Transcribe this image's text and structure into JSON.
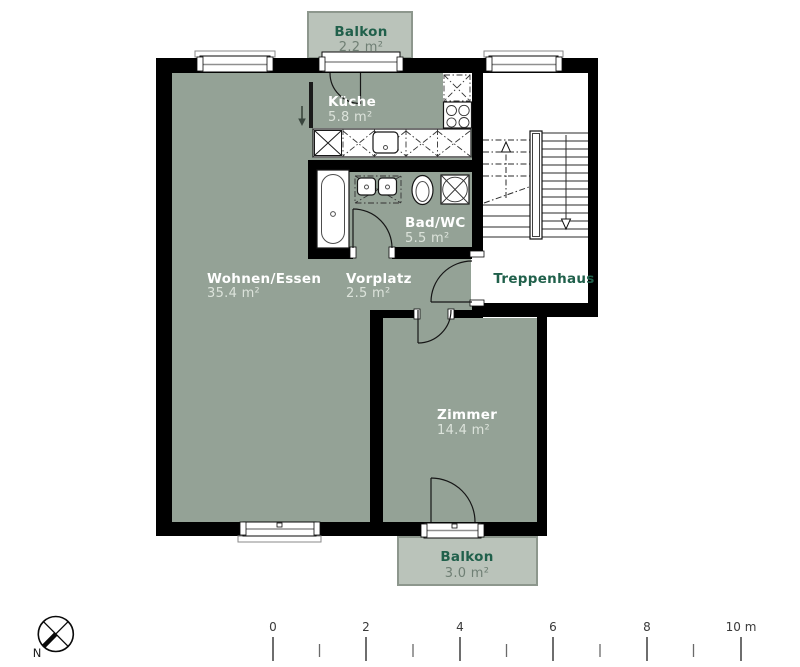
{
  "plan": {
    "rooms": [
      {
        "id": "balkon-top",
        "name": "Balkon",
        "area": "2.2 m²"
      },
      {
        "id": "kueche",
        "name": "Küche",
        "area": "5.8 m²"
      },
      {
        "id": "bad-wc",
        "name": "Bad/WC",
        "area": "5.5 m²"
      },
      {
        "id": "wohnen-essen",
        "name": "Wohnen/Essen",
        "area": "35.4 m²"
      },
      {
        "id": "vorplatz",
        "name": "Vorplatz",
        "area": "2.5 m²"
      },
      {
        "id": "treppenhaus",
        "name": "Treppenhaus",
        "area": ""
      },
      {
        "id": "zimmer",
        "name": "Zimmer",
        "area": "14.4 m²"
      },
      {
        "id": "balkon-bottom",
        "name": "Balkon",
        "area": "3.0 m²"
      }
    ],
    "fixtures": [
      "bathtub",
      "double-washbasin",
      "toilet",
      "washing-machine",
      "stove",
      "kitchen-sink",
      "refrigerator",
      "staircase"
    ],
    "compass": {
      "label": "N"
    },
    "scale_bar": {
      "unit": "m",
      "tick_labels": [
        "0",
        "2",
        "4",
        "6",
        "8",
        "10 m"
      ]
    },
    "colors": {
      "wall": "#000000",
      "room_fill": "#94A296",
      "balcony_fill": "#BAC3BA",
      "balcony_stroke": "#8D978D",
      "label_green": "#20604B",
      "room_name": "#FFFFFF",
      "area_light": "#DCE3DB",
      "area_dark": "#6F7F74"
    }
  }
}
